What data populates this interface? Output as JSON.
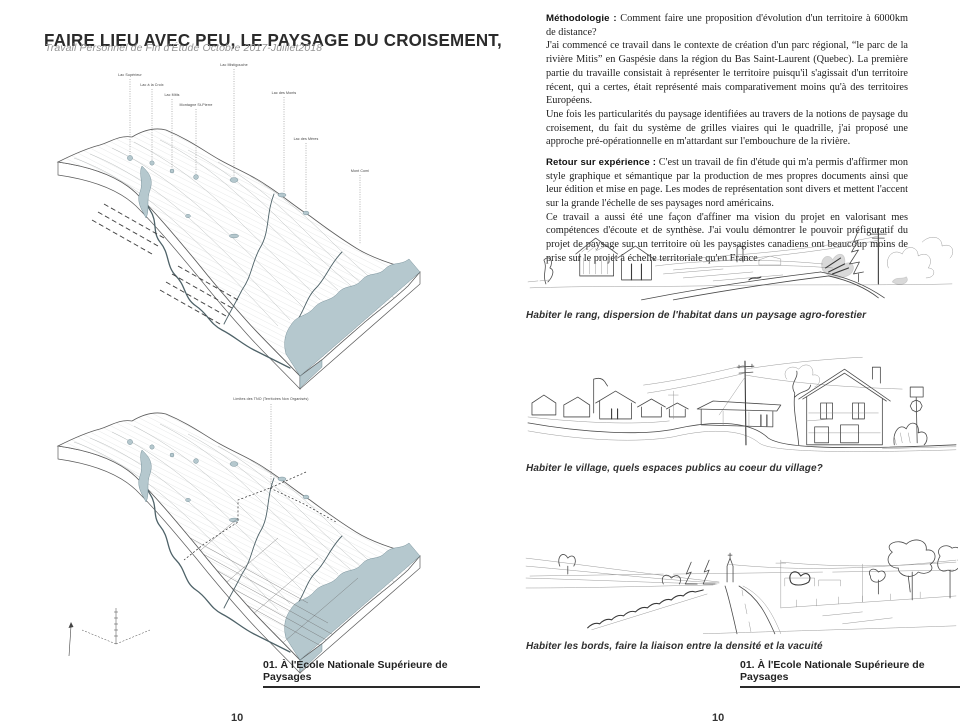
{
  "left_page": {
    "title": "FAIRE LIEU AVEC PEU, LE PAYSAGE DU CROISEMENT,",
    "subtitle": "Travail Personnel de Fin d'Étude Octobre 2017-Juillet2018",
    "footer_caption": "01. À l'Ecole Nationale Supérieure de Paysages",
    "page_number": "10",
    "map_top": {
      "lake_labels": [
        "Lac Supérieur",
        "Lac à la Croix",
        "Lac Mitis",
        "Montagne St-Pierre",
        "Lac Mistigouche",
        "Lac des Monts"
      ],
      "side_labels": [
        "Lac des Mères",
        "Mont Comi"
      ]
    },
    "map_bottom": {
      "boundary_label": "Limites des TNO (Territoires Non Organisés)"
    }
  },
  "right_page": {
    "paragraphs": [
      {
        "lead": "Méthodologie :",
        "body": "Comment faire une proposition d'évolution d'un territoire à 6000km de distance?\nJ'ai commencé ce travail dans le contexte de création d'un parc régional, “le parc de la rivière Mitis” en Gaspésie dans la région du Bas Saint-Laurent (Quebec).  La première partie du travaille consistait à représenter le territoire puisqu'il s'agissait d'un territoire récent, qui a certes, était représenté mais comparativement moins qu'à des territoires Européens.\nUne fois les particularités du paysage identifiées au travers de la notions de paysage du croisement, du fait du système de grilles viaires qui le quadrille, j'ai proposé une approche pré-opérationnelle en m'attardant sur l'embouchure de la rivière."
      },
      {
        "lead": "Retour sur expérience :",
        "body": "C'est un travail de fin d'étude qui m'a permis d'affirmer mon style graphique et sémantique par la production de mes propres documents ainsi que leur édition et mise en page. Les modes de représentation sont divers et mettent l'accent sur la grande l'échelle de ses paysages nord américains.\nCe travail a aussi été une façon d'affiner ma vision du projet en valorisant mes compétences d'écoute et de synthèse. J'ai voulu démontrer le pouvoir préfiguratif du projet de paysage sur un territoire où les paysagistes canadiens ont beaucoup moins de prise sur le projet à échelle territoriale qu'en France."
      }
    ],
    "captions": [
      "Habiter le rang, dispersion de l'habitat dans un paysage agro-forestier",
      "Habiter le village, quels espaces publics au coeur du village?",
      "Habiter les bords, faire la liaison entre la densité et la vacuité"
    ],
    "footer_caption": "01. À l'Ecole Nationale Supérieure de Paysages",
    "page_number": "10"
  },
  "colors": {
    "water": "#b5c8ce",
    "ink": "#4a4a4a",
    "map-ink": "#5c5c5c",
    "text": "#1e1e1e",
    "muted": "#949494"
  }
}
